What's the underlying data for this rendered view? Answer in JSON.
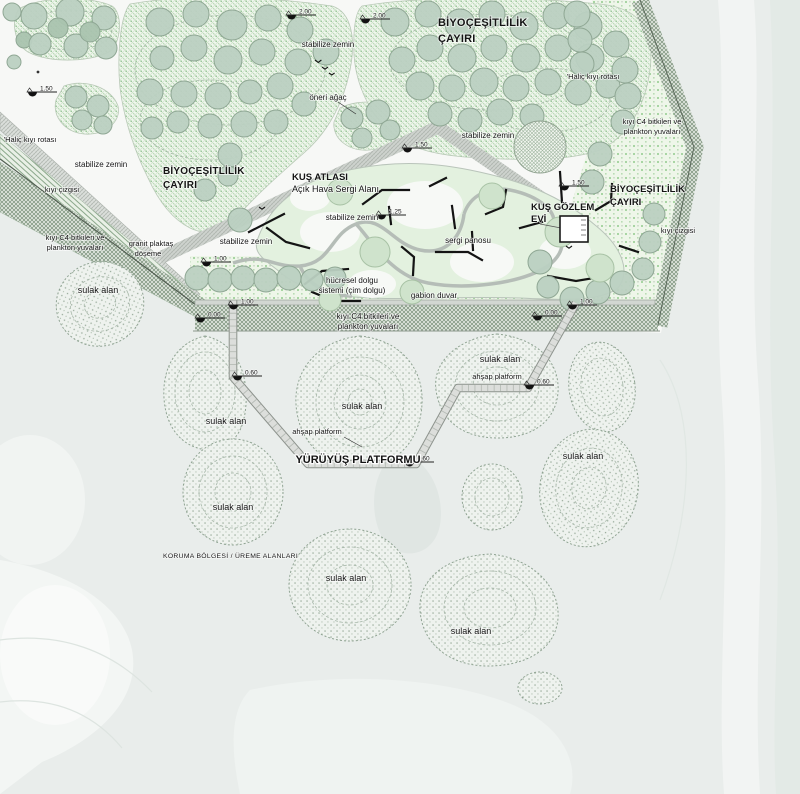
{
  "plan": {
    "labels": {
      "biyo_line1": "BİYOÇEŞİTLİLİK",
      "biyo_line2": "ÇAYIRI",
      "kus_atlasi_line1": "KUŞ ATLASI",
      "kus_atlasi_line2": "Açık Hava Sergi Alanı",
      "kus_gozlem_line1": "KUŞ GÖZLEM",
      "kus_gozlem_line2": "EVİ",
      "stabilize_zemin": "stabilize zemin",
      "sulak_alan": "sulak alan",
      "halic_kiyi_rotasi": "'Haliç kıyı rotası",
      "kiyi_cizgisi": "kıyı çizgisi",
      "kiyi_c4_line1": "kıyı C4 bitkileri ve",
      "kiyi_c4_line2": "plankton yuvaları",
      "granit_line1": "granit plaktaş",
      "granit_line2": "döşeme",
      "oneri_agac": "öneri ağaç",
      "sergi_panosu": "sergi panosu",
      "hucresel_line1": "hücresel dolgu",
      "hucresel_line2": "sistemi (çim dolgu)",
      "gabion_duvar": "gabion duvar",
      "ahsap_platform": "ahşap platform",
      "yuruyus_platformu": "YÜRÜYÜŞ PLATFORMU",
      "koruma_bolgesi": "KORUMA BÖLGESİ / ÜREME ALANLARI"
    },
    "elevations": {
      "e200": "2.00",
      "e150": "1.50",
      "e125": "1.25",
      "e100": "1.00",
      "e060": "0.60",
      "e000": "0.00"
    },
    "colors": {
      "water": "#e9edeb",
      "park_ground": "#f7f8f6",
      "meadow_dot_green": "#8cc08c",
      "tree_fill": "#bad0c1",
      "tree_outline": "#8fa794",
      "coastal_band_hatch": "#839883",
      "wetland_dot": "#98aa9a",
      "walkway_fill": "#dcdedb",
      "exhibit_green": "#e3f1df",
      "panel_black": "#141414"
    }
  }
}
